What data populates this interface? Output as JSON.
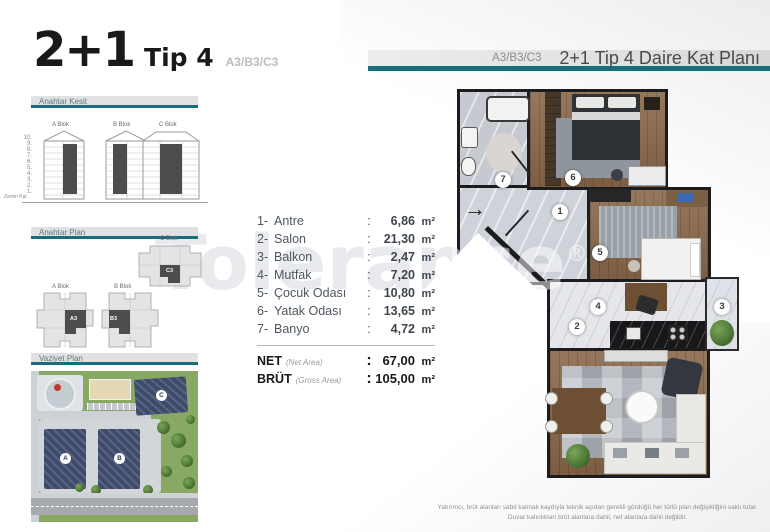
{
  "ui": {
    "colon": ":"
  },
  "title": {
    "main": "2+1",
    "sub": "Tip 4",
    "code": "A3/B3/C3"
  },
  "sections": {
    "kesit": "Anahtar Kesit",
    "plan": "Anahtar Plan",
    "vaziyet": "Vaziyet Plan"
  },
  "kesit": {
    "blocks": [
      {
        "label": "A Blok"
      },
      {
        "label": "B Blok"
      },
      {
        "label": "C Blok"
      }
    ],
    "floors": [
      "10.",
      "9.",
      "8.",
      "7.",
      "6.",
      "5.",
      "4.",
      "3.",
      "2.",
      "1."
    ],
    "ground": "Zemin Kat"
  },
  "anahtar_plan": {
    "blocks": [
      {
        "label": "C Blok",
        "unit": "C3"
      },
      {
        "label": "A Blok",
        "unit": "A3"
      },
      {
        "label": "B Blok",
        "unit": "B3"
      }
    ]
  },
  "vaziyet": {
    "buildings": [
      "A",
      "B",
      "C"
    ]
  },
  "header": {
    "code": "A3/B3/C3",
    "title": "2+1 Tip 4 Daire Kat Planı"
  },
  "rooms": [
    {
      "no": "1-",
      "name": "Antre",
      "value": "6,86",
      "unit": "m²"
    },
    {
      "no": "2-",
      "name": "Salon",
      "value": "21,30",
      "unit": "m²"
    },
    {
      "no": "3-",
      "name": "Balkon",
      "value": "2,47",
      "unit": "m²"
    },
    {
      "no": "4-",
      "name": "Mutfak",
      "value": "7,20",
      "unit": "m²"
    },
    {
      "no": "5-",
      "name": "Çocuk Odası",
      "value": "10,80",
      "unit": "m²"
    },
    {
      "no": "6-",
      "name": "Yatak Odası",
      "value": "13,65",
      "unit": "m²"
    },
    {
      "no": "7-",
      "name": "Banyo",
      "value": "4,72",
      "unit": "m²"
    }
  ],
  "totals": [
    {
      "label": "NET",
      "sub": "(Net Area)",
      "value": "67,00",
      "unit": "m²"
    },
    {
      "label": "BRÜT",
      "sub": "(Gross Area)",
      "value": "105,00",
      "unit": "m²"
    }
  ],
  "plan": {
    "numbers": [
      "1",
      "2",
      "3",
      "4",
      "5",
      "6",
      "7"
    ],
    "entry_arrow": "→"
  },
  "watermark": {
    "text": "Tolerance",
    "reg": "®"
  },
  "disclaimer": {
    "line1": "Yatırımcı, brüt alanları sabit kalmak kaydıyla teknik açıdan gerekli gördüğü her türlü plan değişikliğini saklı tutar.",
    "line2": "Duvar kalınlıkları brüt alanlara dahil, net alanlara dahil değildir."
  },
  "colors": {
    "accent_teal": "#176d79",
    "wall_dark": "#1c1c1e",
    "highlight_unit": "#4d4d4f"
  }
}
